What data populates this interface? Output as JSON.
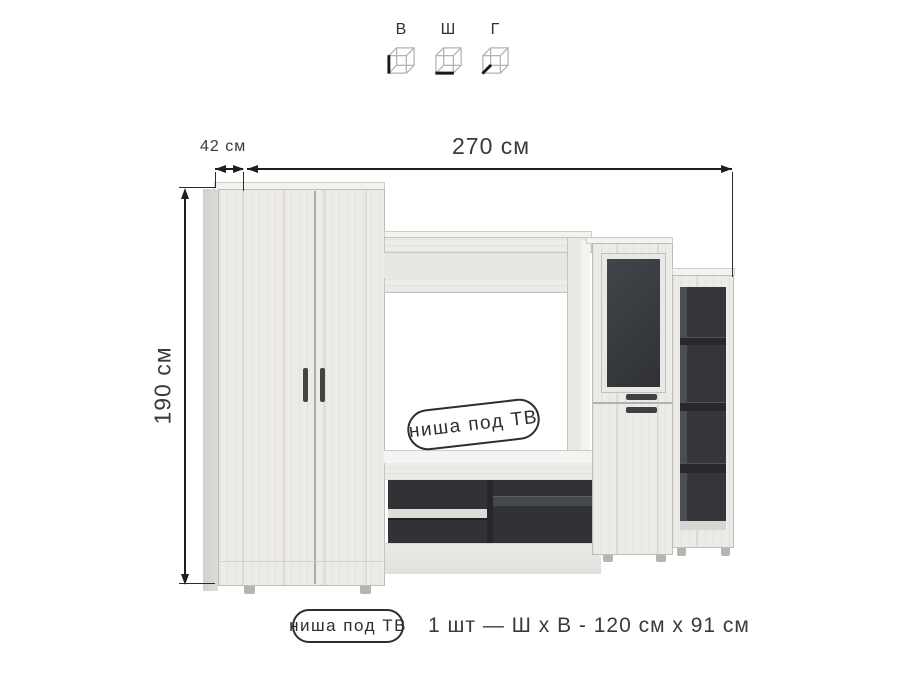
{
  "legend": {
    "items": [
      {
        "letter": "В",
        "icon": "cube-height-edge"
      },
      {
        "letter": "Ш",
        "icon": "cube-width-edge"
      },
      {
        "letter": "Г",
        "icon": "cube-depth-edge"
      }
    ]
  },
  "dims": {
    "depth": "42 см",
    "width": "270 см",
    "height": "190 см"
  },
  "niche_badge": "ниша под ТВ",
  "caption": {
    "badge": "ниша под ТВ",
    "text": "1 шт — Ш х В - 120 см х 91 см"
  },
  "colors": {
    "wood": "#ecebe8",
    "wood_edge": "#bfbdb9",
    "dark_interior": "#303236",
    "glass": "#3a3d41",
    "handle": "#3e4043",
    "dimension_line": "#1f1f1f",
    "text": "#3a3a3a"
  }
}
